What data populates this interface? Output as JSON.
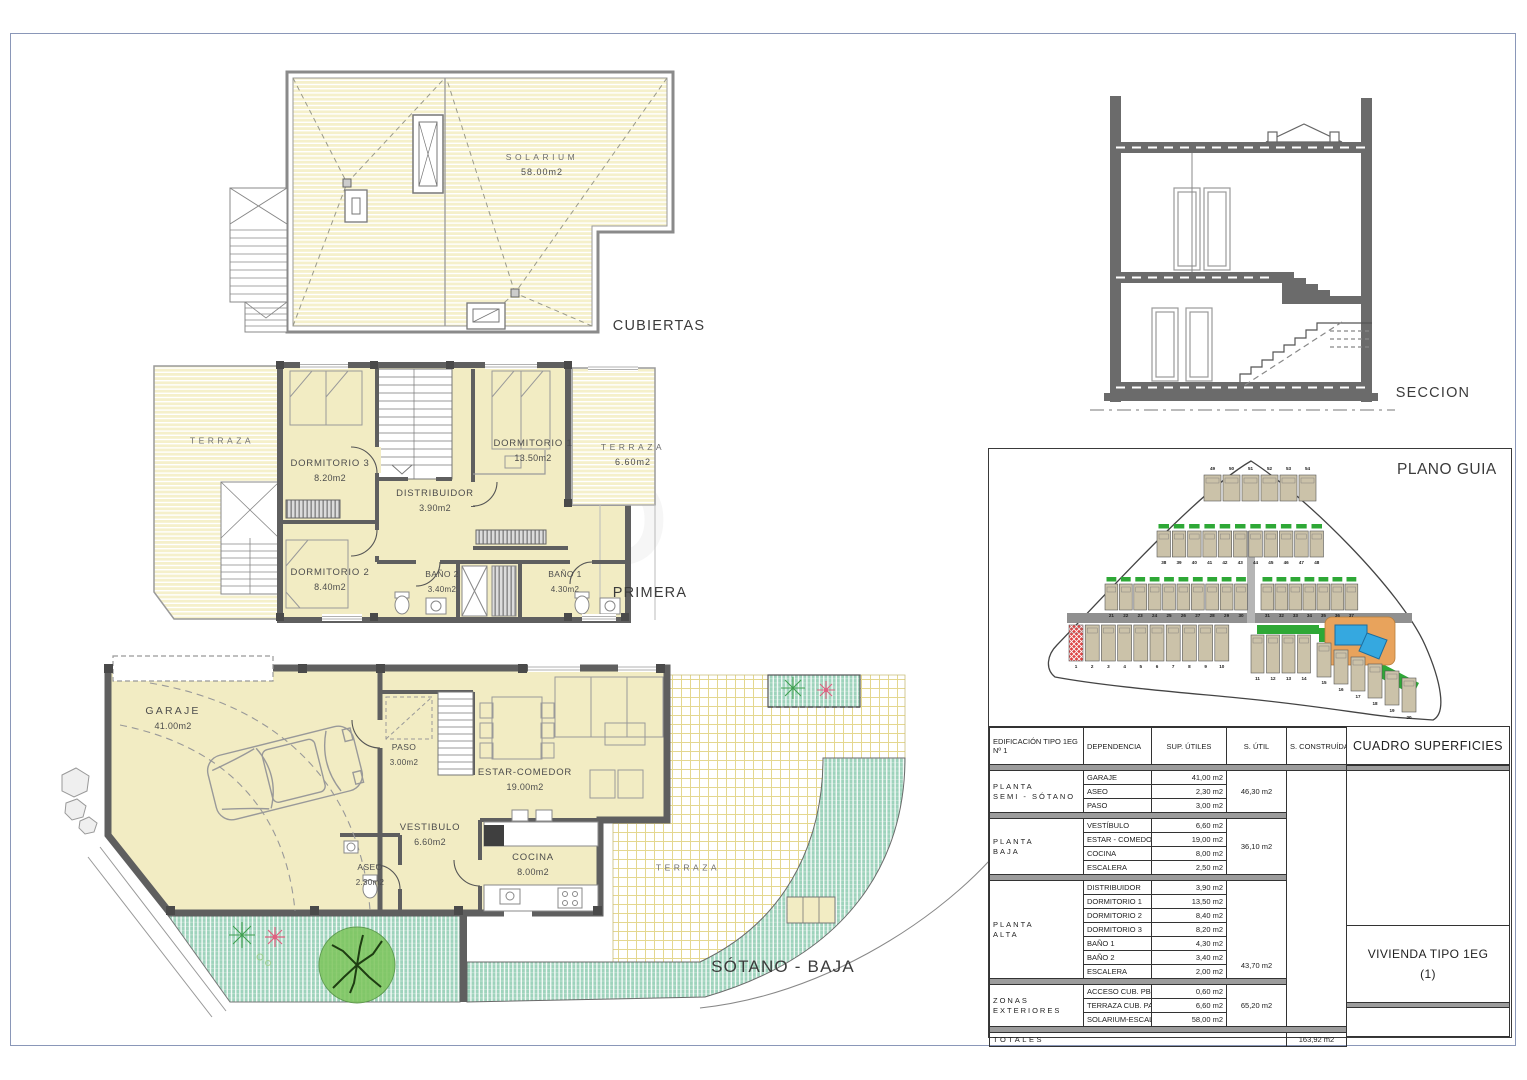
{
  "plans": {
    "cubiertas": {
      "title": "CUBIERTAS",
      "solarium": {
        "name": "SOLARIUM",
        "area": "58.00m2"
      }
    },
    "primera": {
      "title": "PRIMERA",
      "terraza_left": {
        "name": "TERRAZA"
      },
      "dormitorio3": {
        "name": "DORMITORIO 3",
        "area": "8.20m2"
      },
      "dormitorio1": {
        "name": "DORMITORIO 1",
        "area": "13.50m2"
      },
      "terraza_right": {
        "name": "TERRAZA",
        "area": "6.60m2"
      },
      "distribuidor": {
        "name": "DISTRIBUIDOR",
        "area": "3.90m2"
      },
      "dormitorio2": {
        "name": "DORMITORIO 2",
        "area": "8.40m2"
      },
      "bano2": {
        "name": "BAÑO 2",
        "area": "3.40m2"
      },
      "bano1": {
        "name": "BAÑO 1",
        "area": "4.30m2"
      }
    },
    "sotano_baja": {
      "title": "SÓTANO - BAJA",
      "garaje": {
        "name": "GARAJE",
        "area": "41.00m2"
      },
      "paso": {
        "name": "PASO",
        "area": "3.00m2"
      },
      "estar_comedor": {
        "name": "ESTAR-COMEDOR",
        "area": "19.00m2"
      },
      "vestibulo": {
        "name": "VESTIBULO",
        "area": "6.60m2"
      },
      "aseo": {
        "name": "ASEO",
        "area": "2.30m2"
      },
      "cocina": {
        "name": "COCINA",
        "area": "8.00m2"
      },
      "terraza": {
        "name": "TERRAZA"
      }
    },
    "seccion": {
      "title": "SECCION"
    }
  },
  "plano_guia": {
    "title": "PLANO GUIA",
    "highlighted_plot": 1,
    "plot_rows": [
      {
        "from": 49,
        "to": 54
      },
      {
        "from": 38,
        "to": 48
      },
      {
        "from": 21,
        "to": 30
      },
      {
        "from": 31,
        "to": 37
      },
      {
        "from": 1,
        "to": 10
      },
      {
        "from": 11,
        "to": 14
      },
      {
        "from": 15,
        "to": 20
      }
    ]
  },
  "table": {
    "headers": {
      "edificio": "EDIFICACIÓN TIPO 1EG",
      "edificio2": "Nº 1",
      "dependencia": "DEPENDENCIA",
      "sup_utiles": "SUP. ÚTILES",
      "s_util": "S. ÚTIL",
      "s_construida": "S. CONSTRUÍDA",
      "cuadro": "CUADRO SUPERFICIES"
    },
    "groups": [
      {
        "label1": "PLANTA",
        "label2": "SEMI - SÓTANO",
        "s_util": "46,30 m2",
        "rows": [
          [
            "GARAJE",
            "41,00 m2"
          ],
          [
            "ASEO",
            "2,30 m2"
          ],
          [
            "PASO",
            "3,00 m2"
          ]
        ]
      },
      {
        "label1": "PLANTA",
        "label2": "BAJA",
        "s_util": "36,10 m2",
        "rows": [
          [
            "VESTÍBULO",
            "6,60 m2"
          ],
          [
            "ESTAR - COMEDOR",
            "19,00 m2"
          ],
          [
            "COCINA",
            "8,00 m2"
          ],
          [
            "ESCALERA",
            "2,50 m2"
          ]
        ]
      },
      {
        "label1": "PLANTA",
        "label2": "ALTA",
        "s_util": "43,70 m2",
        "rows": [
          [
            "DISTRIBUIDOR",
            "3,90 m2"
          ],
          [
            "DORMITORIO 1",
            "13,50 m2"
          ],
          [
            "DORMITORIO 2",
            "8,40 m2"
          ],
          [
            "DORMITORIO 3",
            "8,20 m2"
          ],
          [
            "BAÑO 1",
            "4,30 m2"
          ],
          [
            "BAÑO 2",
            "3,40 m2"
          ],
          [
            "ESCALERA",
            "2,00 m2"
          ]
        ]
      },
      {
        "label1": "ZONAS",
        "label2": "EXTERIORES",
        "s_util": "65,20 m2",
        "rows": [
          [
            "ACCESO CUB. PB",
            "0,60 m2"
          ],
          [
            "TERRAZA CUB. PA",
            "6,60 m2"
          ],
          [
            "SOLARIUM-ESCAL.",
            "58,00 m2"
          ]
        ]
      }
    ],
    "totales": {
      "label": "TOTALES",
      "s_construida": "163,92 m2"
    },
    "vivienda": {
      "line1": "VIVIENDA TIPO 1EG",
      "line2": "(1)"
    }
  },
  "colors": {
    "room_fill": "#F2ECC3",
    "roof_stripe": "#F5F0CB",
    "wall": "#5F5F5F",
    "garden_green": "#9ED3BC",
    "lawn_green": "#2EA836",
    "pool_blue": "#35A8E0",
    "deck_orange": "#E8A35C",
    "highlight_red": "#DD4444",
    "plot_tan": "#CBC2A9",
    "page_border": "#8A97B8"
  }
}
